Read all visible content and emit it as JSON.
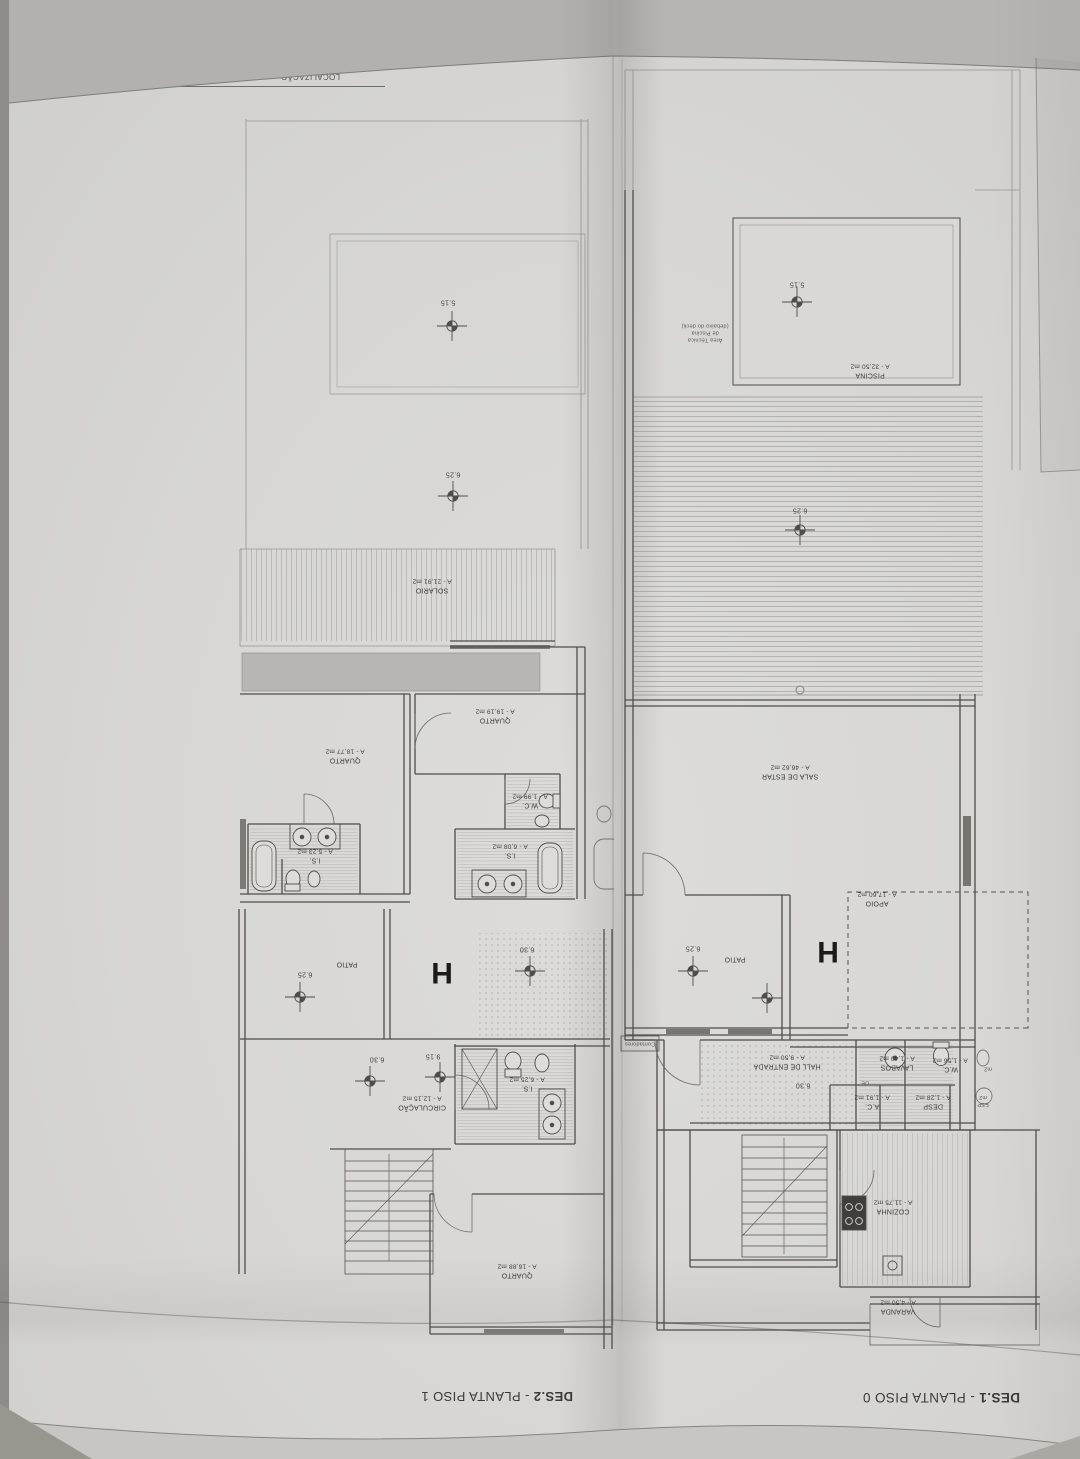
{
  "sheet": {
    "title_block": {
      "localizacao_label": "LOCALIZAÇÃO",
      "localizacao_value": "LOTE 4",
      "fracao_value": "FRAÇÃO \"H\"_MORAD",
      "descricao_label": "DESCRIÇÃO",
      "descricao_value": "PLANTAS_ARQUITETU"
    },
    "piso0": {
      "drawing_code": "DES.1",
      "drawing_title": " - PLANTA PISO 0",
      "fraction_letter": "H",
      "rooms": {
        "piscina": {
          "name": "PISCINA",
          "area": "A - 32,50 m2"
        },
        "sala": {
          "name": "SALA DE ESTAR",
          "area": "A - 46,62 m2"
        },
        "patio": {
          "name": "PATIO",
          "area": ""
        },
        "apoio": {
          "name": "APOIO",
          "area": "A - 17,60 m2"
        },
        "hall": {
          "name": "HALL DE ENTRADA",
          "area": "A - 9,50 m2"
        },
        "lavabos": {
          "name": "LAVABOS",
          "area": "A - 1,40 m2"
        },
        "wc": {
          "name": "W.C.",
          "area": "A - 1,56 m2"
        },
        "desp": {
          "name": "DESP",
          "area": "A - 1,28 m2"
        },
        "ac": {
          "name": "A.C.",
          "area": "A - 1,91 m2"
        },
        "cozinha": {
          "name": "COZINHA",
          "area": "A - 11,75 m2"
        },
        "varanda": {
          "name": "VARANDA",
          "area": "A - 4,50 m2"
        }
      },
      "levels": {
        "piscina": "5.15",
        "deck": "6.25",
        "patio": "6.25",
        "hall": "6.30"
      },
      "annotations": {
        "area_tecnica": "Área Técnica\nde Piscina\n(debaixo do deck)",
        "contadores": "Contadores",
        "closet_de": "DE",
        "neighbor_frag_top": "m2",
        "neighbor_frag_bottom": "ESP\nm2"
      }
    },
    "piso1": {
      "drawing_code": "DES.2",
      "drawing_title": " - PLANTA PISO 1",
      "fraction_letter": "H",
      "rooms": {
        "solario": {
          "name": "SOLARIO",
          "area": "A - 21,91 m2"
        },
        "quarto1": {
          "name": "QUARTO",
          "area": "A - 19,19 m2"
        },
        "quarto2": {
          "name": "QUARTO",
          "area": "A - 18,77 m2"
        },
        "quarto3": {
          "name": "QUARTO",
          "area": "A - 16,88 m2"
        },
        "wc": {
          "name": "W.C.",
          "area": "A - 1,99 m2"
        },
        "is1": {
          "name": "I.S.",
          "area": "A - 6,08 m2"
        },
        "is2": {
          "name": "I.S.",
          "area": "A - 5,23 m2"
        },
        "is3": {
          "name": "I.S.",
          "area": "A - 6,25 m2"
        },
        "circulacao": {
          "name": "CIRCULAÇÃO",
          "area": "A - 12,15 m2"
        },
        "patio": {
          "name": "PATIO",
          "area": ""
        }
      },
      "levels": {
        "pool": "5.15",
        "terrace": "6.25",
        "patio": "6.25",
        "hall": "6.30",
        "stair_mid": "9.15",
        "stair_top": "6.30"
      }
    }
  }
}
